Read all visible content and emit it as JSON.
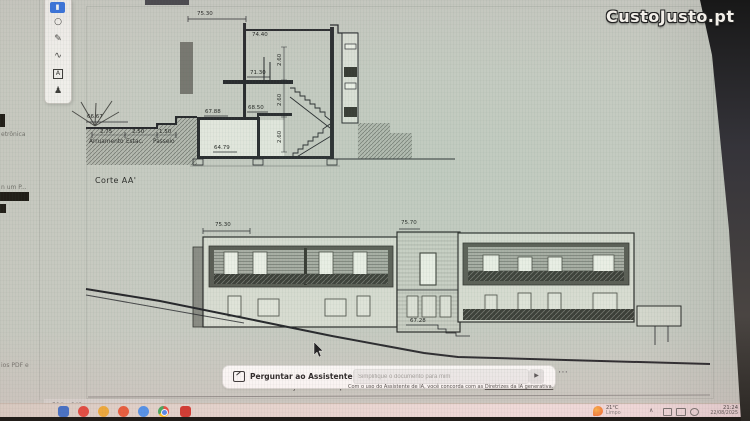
{
  "watermark": {
    "text": "CustoJusto.pt"
  },
  "toolbar": {
    "items": [
      {
        "name": "active-annotation-tool",
        "glyph": "▮"
      },
      {
        "name": "comment-tool",
        "glyph": "○"
      },
      {
        "name": "pen-tool",
        "glyph": "✎"
      },
      {
        "name": "scribble-tool",
        "glyph": "∿"
      },
      {
        "name": "textbox-tool",
        "glyph": "A"
      },
      {
        "name": "stamp-tool",
        "glyph": "♟"
      }
    ]
  },
  "panel_fragments": {
    "line1": "etrônica",
    "line2": "n um P...",
    "line3": "ios PDF e"
  },
  "drawing": {
    "section": {
      "title": "Corte AA'",
      "levels": {
        "top": "75.30",
        "roof": "74.40",
        "floor1": "71.30",
        "entry_low": "67.88",
        "entry_high": "68.50",
        "basement": "64.79",
        "street": "66.67"
      },
      "heights": {
        "h1": "2.60",
        "h2": "2.60",
        "h3": "2.60"
      },
      "street_dims": {
        "road": "2.75",
        "parking": "2.50",
        "sidewalk": "1.50"
      },
      "street_labels": {
        "road": "Arruamento",
        "parking": "Estac.",
        "sidewalk": "Passeio"
      }
    },
    "elevation": {
      "title": "Alçado Principal",
      "levels": {
        "left_top": "75.30",
        "tower_top": "75.70",
        "entry": "67.28"
      }
    }
  },
  "ai_assistant": {
    "title": "Perguntar ao Assistente de IA",
    "input_placeholder": "Simplifique o documento para mim",
    "send_glyph": "▶",
    "more_glyph": "⋯",
    "disclaimer_text": "Com o uso do Assistente de IA, você concorda com as ",
    "disclaimer_link": "Diretrizes da IA generativa."
  },
  "status_bar": {
    "page_size": "594 x 841 mm"
  },
  "taskbar": {
    "weather": {
      "temperature": "21°C",
      "condition": "Limpo"
    },
    "clock": {
      "time": "21:24",
      "date": "22/08/2025"
    },
    "app_colors": [
      "#2a66c8",
      "#e23b2e",
      "#f0a928",
      "#e8512b",
      "#3f8ef0",
      "chrome",
      "#cf2b20"
    ]
  },
  "colors": {
    "accent_blue": "#2f6fe0",
    "screen_bg": "#c8cbc2",
    "band_dark": "#5a5b53"
  }
}
